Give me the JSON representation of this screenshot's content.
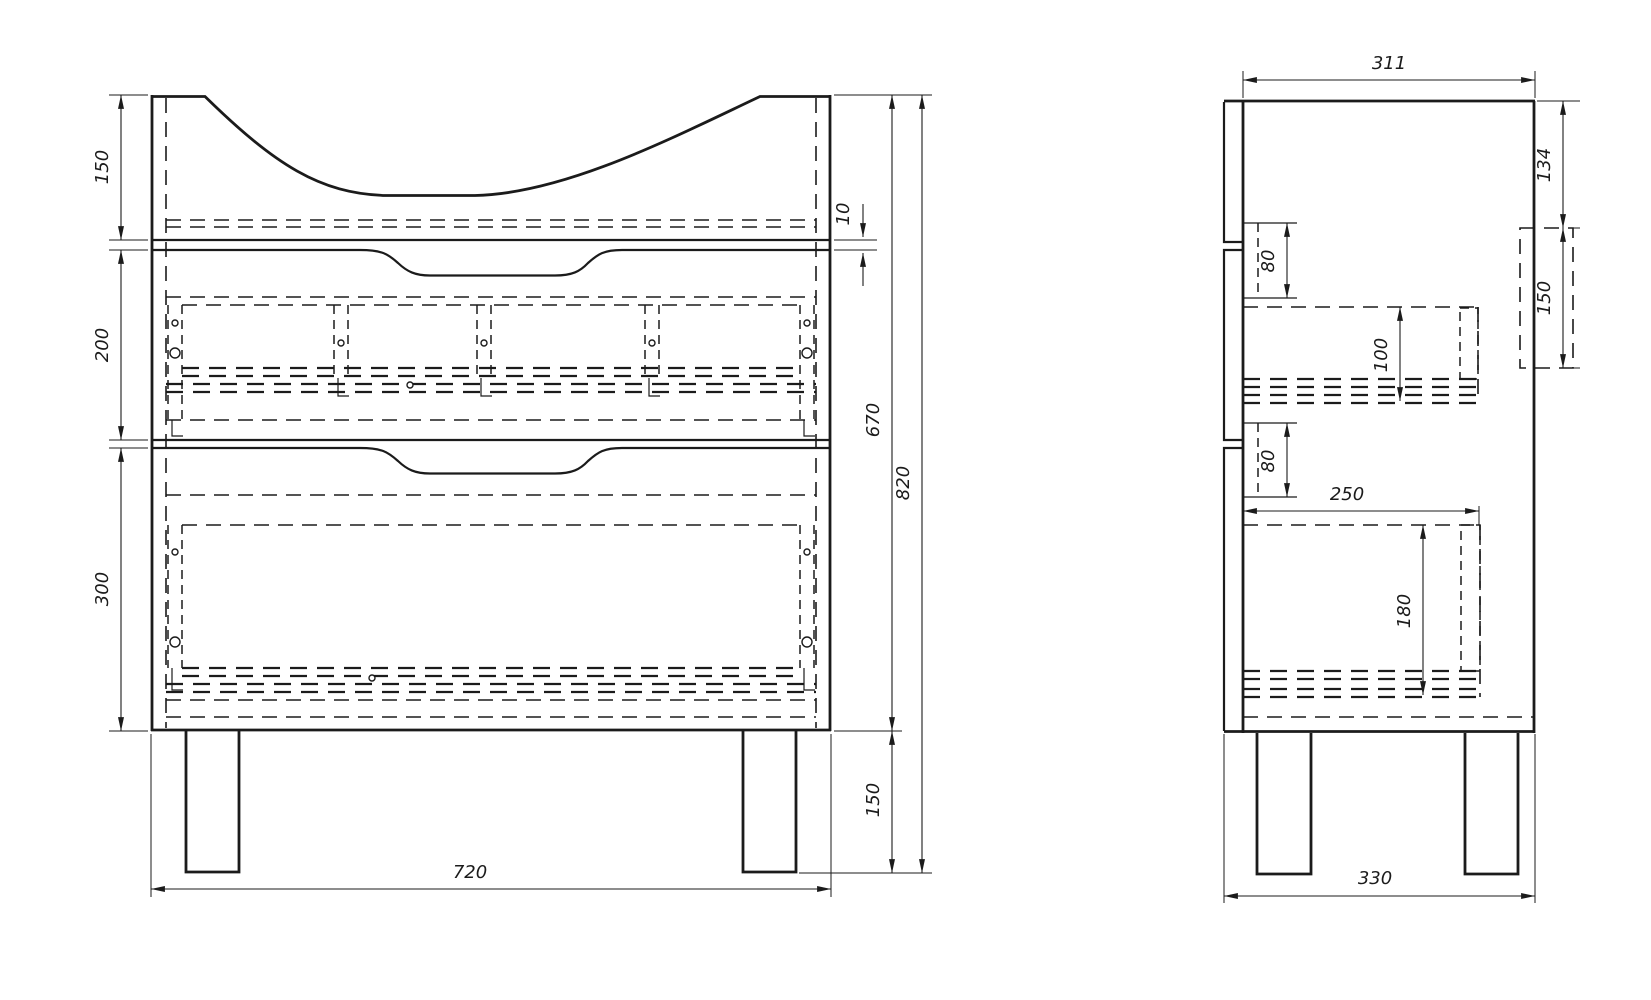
{
  "drawing": {
    "type": "technical-drawing",
    "subject": "vanity cabinet two-view dimensioned drawing",
    "colors": {
      "background": "#ffffff",
      "line": "#1b1b1b"
    },
    "front_view": {
      "dims": {
        "top_section_height": "150",
        "gap": "10",
        "drawer1_height": "200",
        "drawer2_height": "300",
        "body_height": "670",
        "overall_height": "820",
        "leg_height": "150",
        "overall_width": "720"
      }
    },
    "side_view": {
      "dims": {
        "depth_top": "311",
        "back_top_offset": "134",
        "back_cutout_height": "150",
        "slide_top_offset": "80",
        "drawer1_box_height": "100",
        "slide_bottom_offset": "80",
        "drawer_depth": "250",
        "drawer2_box_height": "180",
        "overall_depth": "330"
      }
    }
  }
}
